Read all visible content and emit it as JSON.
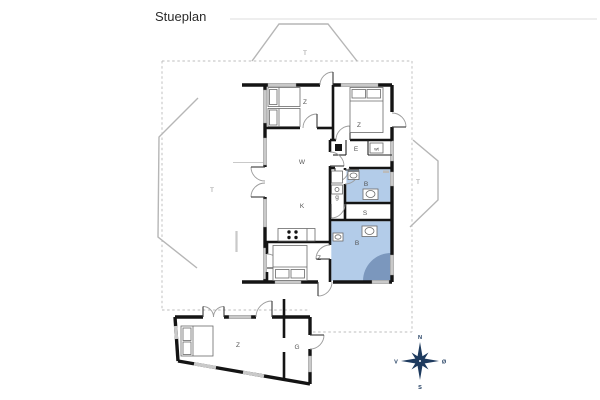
{
  "header": {
    "title": "Stueplan"
  },
  "rooms": {
    "terrace_top": "T",
    "terrace_left": "T",
    "terrace_right": "T",
    "bedroom_top_left": "Z",
    "bedroom_top_right": "Z",
    "bedroom_bottom": "Z",
    "living_room": "W",
    "kitchen": "K",
    "entry": "E",
    "bathroom_top": "B",
    "bathroom_bottom": "B",
    "hallway": "g",
    "storage": "S",
    "annex_bedroom": "Z",
    "annex_garage": "G",
    "washer": "wt"
  },
  "compass": {
    "north": "N",
    "south": "S",
    "west": "V",
    "east": "Ø"
  },
  "colors": {
    "bathroom_fill": "#b3cce9",
    "shower_fill": "#7b97bd",
    "compass": "#1d3a5e"
  }
}
